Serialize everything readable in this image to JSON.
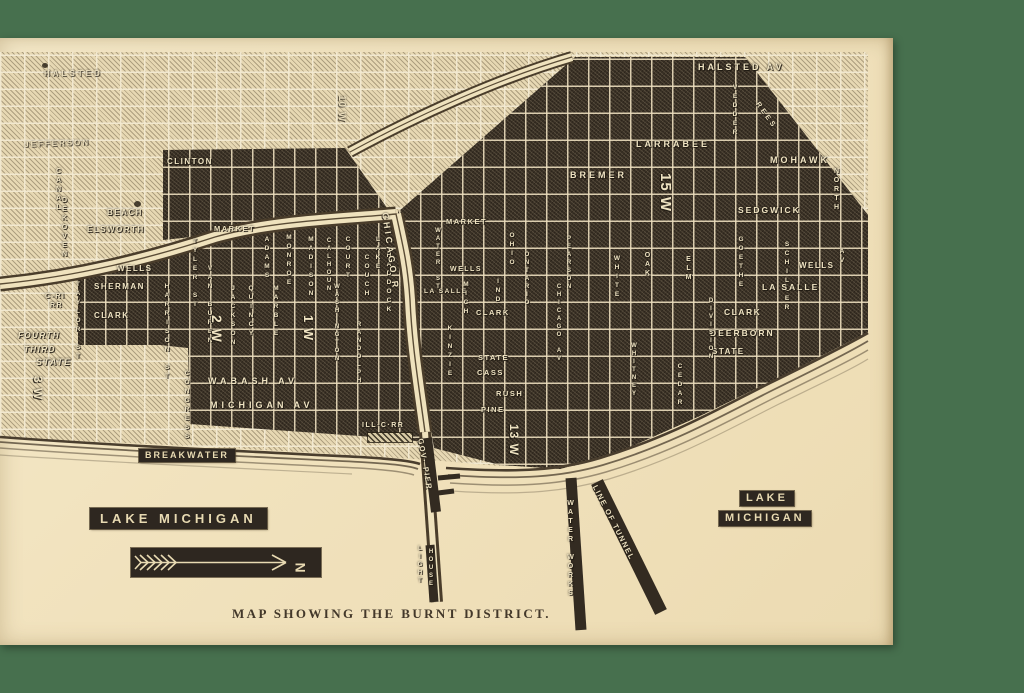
{
  "caption": "MAP SHOWING THE BURNT DISTRICT.",
  "compass": {
    "north_letter": "N"
  },
  "colors": {
    "background": "#47704e",
    "paper": "#f2e4c2",
    "burnt_ink": "#3a3126",
    "light_block": "#e7d8b3",
    "street_line": "#f3ead2",
    "label_text": "#efe3c2",
    "box_bg": "#2e2720",
    "caption_text": "#43382a"
  },
  "water": {
    "breakwater": "BREAKWATER",
    "lake_michigan_left": "LAKE MICHIGAN",
    "lake_right": "LAKE",
    "michigan_right": "MICHIGAN",
    "chicago_river": "CHICAGO R",
    "gov_pier": "GOV· PIER",
    "light": "LIGHT",
    "house": "HOUSE",
    "water_works": "WATER WORKS",
    "line_of_tunnel": "LINE OF TUNNEL",
    "ill_c_rr": "ILL·C·RR"
  },
  "streets": {
    "halsted_w": "HALSTED",
    "jefferson": "JEFFERSON",
    "c_ri": "C-RI",
    "rr": "RR",
    "fourth": "FOURTH",
    "third": "THIRD",
    "state_w": "STATE",
    "three_w": "3 W",
    "ten_w": "10 W",
    "clinton": "CLINTON",
    "canal": "CANAL",
    "dekoven": "DEKOVEN",
    "beach": "BEACH",
    "elsworth": "ELSWORTH",
    "market_w": "MARKET",
    "wells_w": "WELLS",
    "sherman": "SHERMAN",
    "clark_w": "CLARK",
    "taylor": "TAYLOR ST",
    "harrison": "HARRISON ST",
    "tyler": "TYLER ST",
    "vanburen": "VAN BUREN",
    "jackson": "JACKSON",
    "quincy": "QUINCY",
    "marble": "MARBLE",
    "adams": "ADAMS",
    "monroe": "MONROE",
    "madison": "MADISON",
    "calhoun": "CALHOUN",
    "court": "COURT",
    "washington": "WASHINGTON",
    "randolph": "RANDOLPH",
    "lake_st": "LAKE",
    "couch": "COUCH",
    "haddock": "HADDOCK",
    "two_w": "2 W",
    "one_w": "1 W",
    "congress": "CONGRESS",
    "wabash": "WABASH AV",
    "michigan_av": "MICHIGAN AV",
    "halsted_av": "HALSTED AV",
    "vedder": "VEDDER",
    "rees": "REES",
    "larrabee": "LARRABEE",
    "mohawk": "MOHAWK",
    "north_st": "NORTH",
    "av": "AV",
    "bremer": "BREMER",
    "fifteen_w": "15 W",
    "sedgwick": "SEDGWICK",
    "goethe": "GOETHE",
    "schiller": "SCHILLER",
    "wells_n": "WELLS",
    "lasalle_n": "LA SALLE",
    "clark_n": "CLARK",
    "deerborn": "DEERBORN",
    "state_n": "STATE",
    "division": "DIVISION",
    "cedar": "CEDAR",
    "whitney": "WHITNEY",
    "elm": "ELM",
    "oak": "OAK",
    "white": "WHITE",
    "pearson": "PEARSON",
    "chicago_av": "CHICAGO AV",
    "ohio": "OHIO",
    "ontario": "ONTARIO",
    "market_n": "MARKET",
    "water_st": "WATER ST",
    "wells_c": "WELLS",
    "lasalle_c": "LA SALLE",
    "mich_c": "MICH",
    "ind": "IND",
    "clark_c": "CLARK",
    "kinzie": "KINZIE",
    "state_c": "STATE",
    "cass": "CASS",
    "rush": "RUSH",
    "pine": "PINE",
    "thirteen_w": "13 W"
  }
}
